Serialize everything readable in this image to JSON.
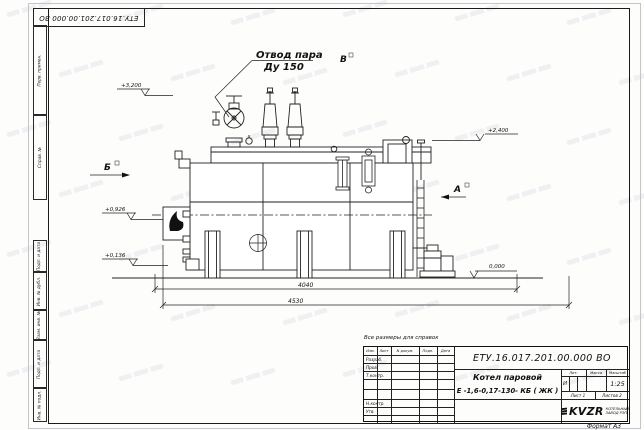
{
  "sheet": {
    "corner_designation": "ЕТУ.16.017.201.00.000  ВО",
    "reference_note": "Все размеры для справок",
    "format_note": "Формат А3"
  },
  "margin_boxes": {
    "top": [
      "Перв. примен.",
      "Справ. №"
    ],
    "bottom": [
      "Подп. и дата",
      "Инв. № дубл.",
      "Взам. инв. №",
      "Подп. и дата",
      "Инв. № подл."
    ]
  },
  "drawing": {
    "callout": {
      "line1": "Отвод пара",
      "line2": "Ду 150"
    },
    "view_markers": {
      "a": "А",
      "b": "Б",
      "v": "В"
    },
    "elevations": {
      "e3200": "+3,200",
      "e2400": "+2,400",
      "e0926": "+0,926",
      "e0136": "+0,136",
      "e0000": "0,000"
    },
    "dimensions": {
      "inner": "4040",
      "outer": "4530"
    }
  },
  "title_block": {
    "designation": "ЕТУ.16.017.201.00.000  ВО",
    "name_line1": "Котел паровой",
    "name_line2": "Е -1,6-0,17-130- КБ ( ЖК )",
    "columns": {
      "izm": "Изм.",
      "list": "Лист",
      "ndoc": "N докум.",
      "podp": "Подп.",
      "data": "Дата"
    },
    "rows": {
      "razrab": "Разраб.",
      "prov": "Пров.",
      "tkontr": "Т.контр.",
      "nkontr": "Н.контр.",
      "utv": "Утв."
    },
    "lit_label": "Лит.",
    "mass_label": "Масса",
    "scale_label": "Масштаб",
    "lit_value": "И",
    "scale_value": "1:25",
    "sheet_label": "Лист 1",
    "sheets_label": "Листов 2",
    "logo_text": "KVZR",
    "logo_caption_line1": "КОТЕЛЬНЫЙ",
    "logo_caption_line2": "ЗАВОД РЭП"
  }
}
